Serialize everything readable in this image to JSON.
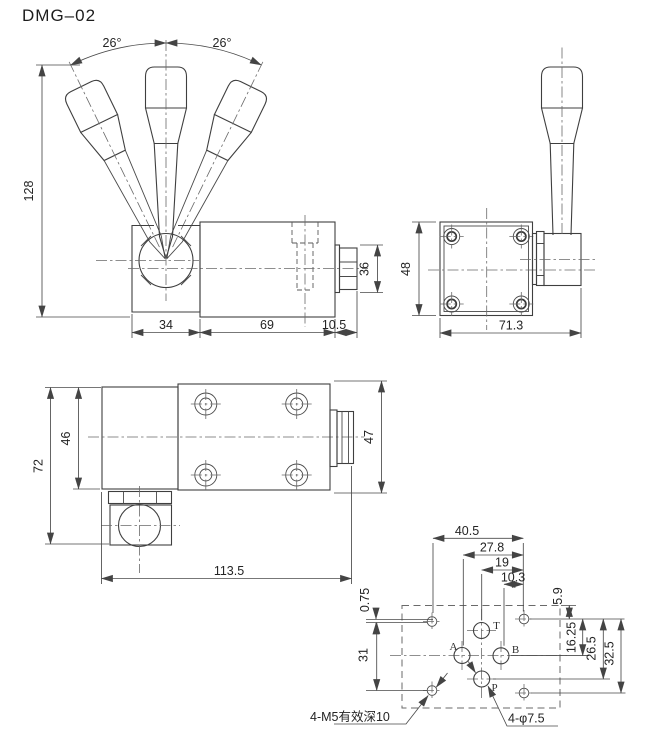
{
  "title": "DMG–02",
  "front_view": {
    "angle_left": "26°",
    "angle_right": "26°",
    "dim_height": "128",
    "dim_block_width": "34",
    "dim_body_width": "69",
    "dim_nut_width": "10.5",
    "dim_nut_height": "36"
  },
  "side_view": {
    "dim_height": "48",
    "dim_width": "71.3"
  },
  "top_view": {
    "dim_overall_height": "72",
    "dim_body_height": "46",
    "dim_nut_height": "47",
    "dim_length": "113.5"
  },
  "mounting_view": {
    "dims_top": {
      "d1": "40.5",
      "d2": "27.8",
      "d3": "19",
      "d4": "10.3"
    },
    "dims_left": {
      "offset": "0.75",
      "spacing": "31"
    },
    "dims_right": {
      "d1": "5.9",
      "d2": "16.25",
      "d3": "26.5",
      "d4": "32.5"
    },
    "ports": {
      "t": "T",
      "a": "A",
      "b": "B",
      "p": "P"
    },
    "label_mounting_holes": "4-M5有效深10",
    "label_port_holes": "4-φ7.5"
  }
}
